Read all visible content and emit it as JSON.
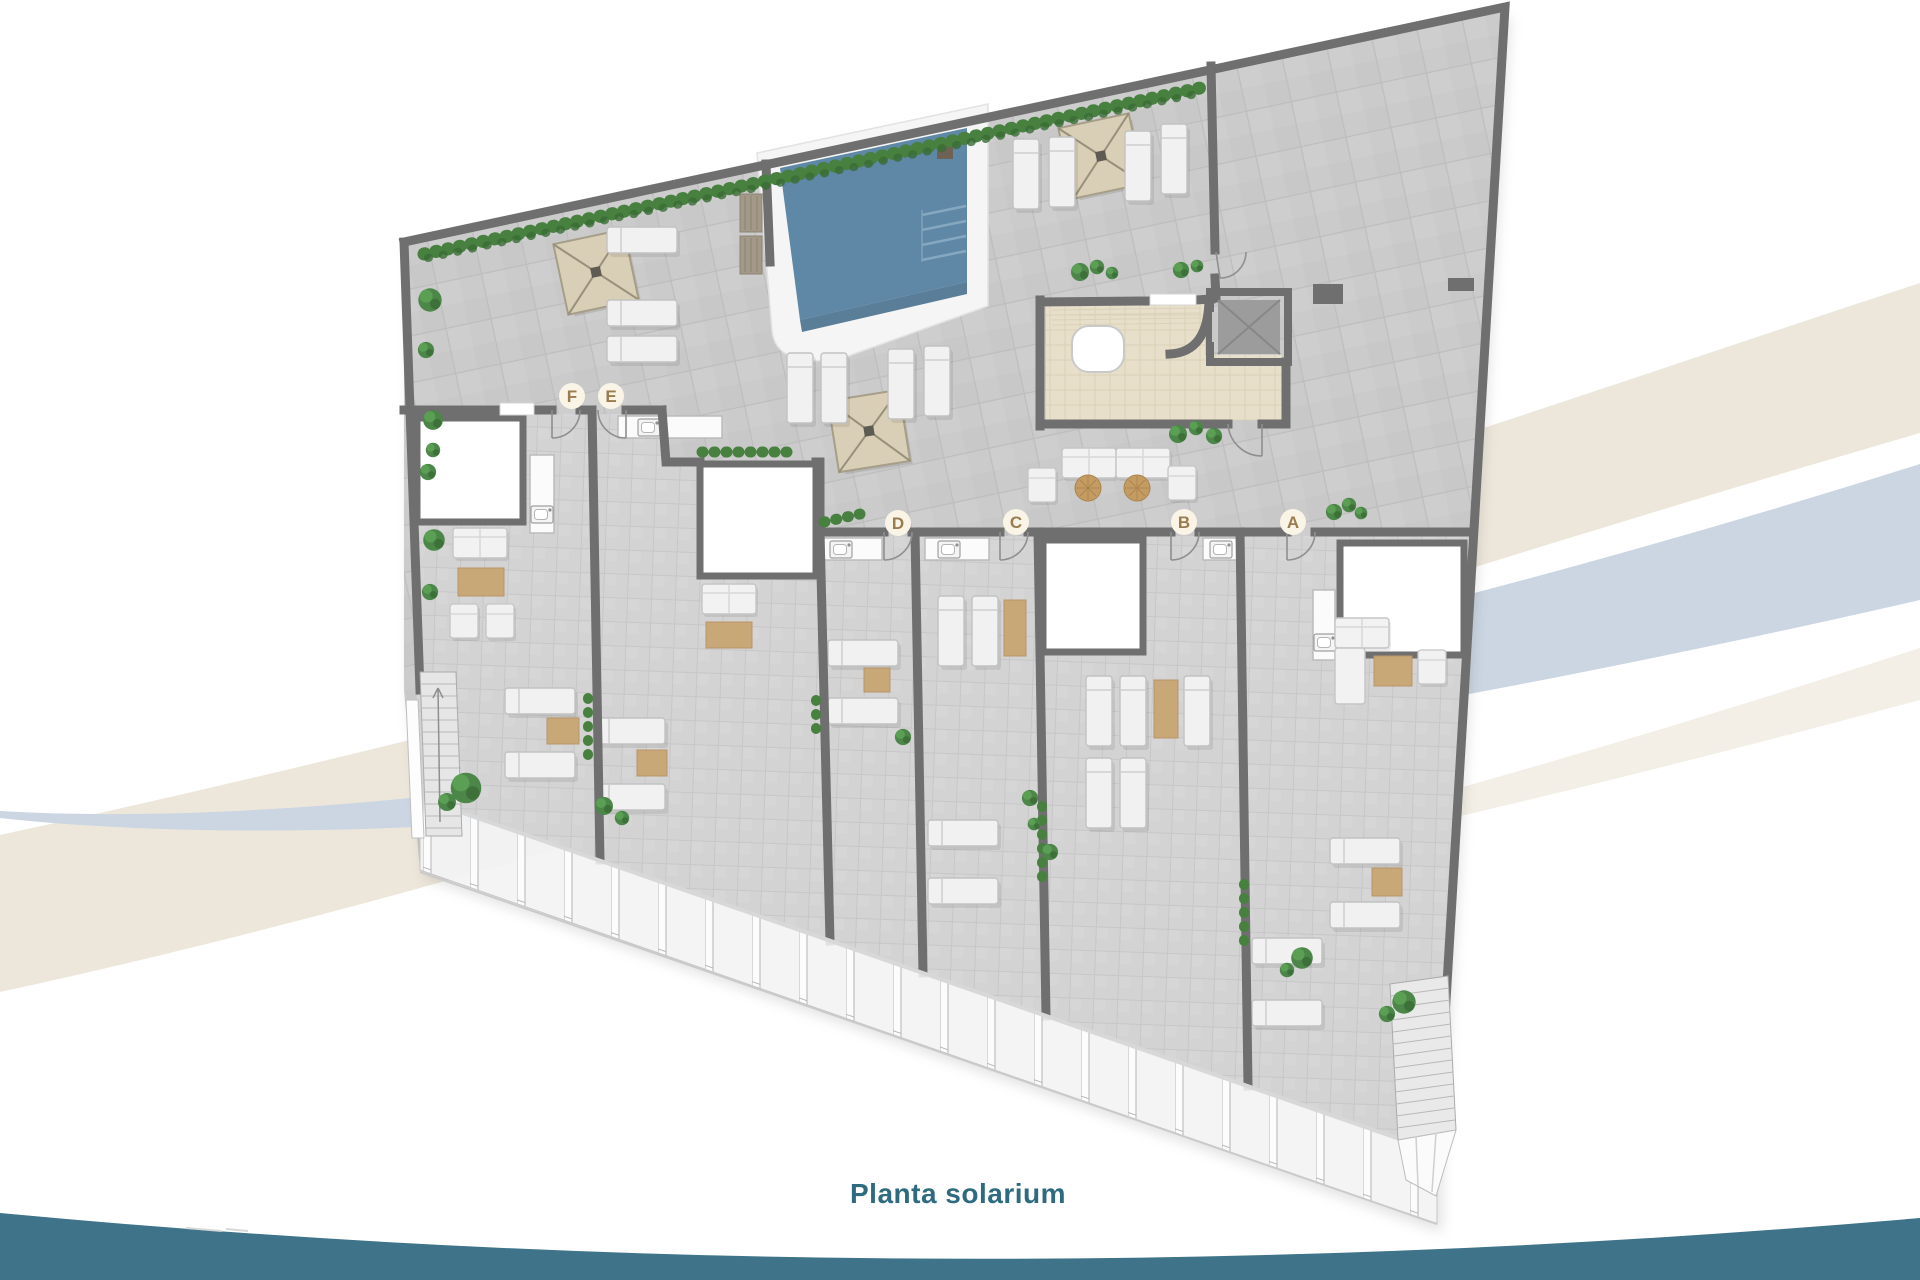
{
  "page": {
    "title": "Planta solarium"
  },
  "floor_plan": {
    "name": "Planta solarium",
    "unit_labels": [
      {
        "letter": "A"
      },
      {
        "letter": "B"
      },
      {
        "letter": "C"
      },
      {
        "letter": "D"
      },
      {
        "letter": "E"
      },
      {
        "letter": "F"
      }
    ],
    "features": [
      "swimming-pool",
      "pool-steps",
      "pergolas",
      "sun-loungers",
      "outdoor-bar",
      "elevator",
      "staircases",
      "private-terraces",
      "skylight-boxes",
      "kitchenettes",
      "planters",
      "glass-railing"
    ]
  },
  "colors": {
    "title_text": "#2E6B80",
    "wave_teal": "#3E7389",
    "ribbon_beige": "#EDE7DB",
    "ribbon_blue": "#CBD6E2",
    "pool_water": "#5E88A6",
    "wall_gray": "#6F6F6F",
    "floor_tile": "#CCCCCC",
    "bar_floor": "#E7DFCA",
    "pergola_canvas": "#D9CFB7",
    "badge_bg": "#FAF4E7",
    "badge_letter": "#9A7B4F",
    "plant_green": "#4C8749",
    "lounger_white": "#F1F1F1",
    "mat_tan": "#C9A878"
  }
}
